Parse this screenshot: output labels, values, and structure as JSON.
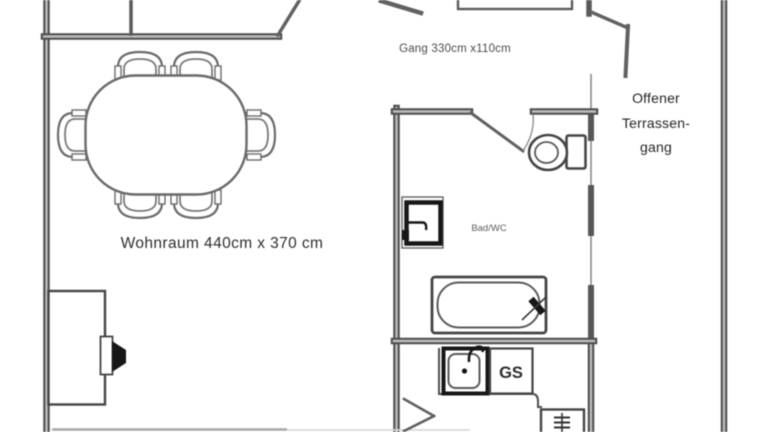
{
  "rooms": [
    {
      "name": "Wohnraum",
      "label": "Wohnraum 440cm x 370 cm"
    },
    {
      "name": "Gang",
      "label": "Gang 330cm x110cm"
    },
    {
      "name": "Bad/WC",
      "label": "Bad/WC"
    },
    {
      "name": "Offener Terrassengang",
      "label_lines": [
        "Offener",
        "Terrassen-",
        "gang"
      ]
    }
  ],
  "fixtures": {
    "dishwasher_label": "GS"
  },
  "colors": {
    "background": "#ffffff",
    "wall": "#4d4d4d",
    "wall_core": "#bdbdbd",
    "fixture_line": "#4f4f4f",
    "fixture_black": "#171717",
    "text_dark": "#2d2d2d",
    "text_muted": "#5d5d5d"
  },
  "icons": {
    "dining-table-icon": "rounded-oval-table",
    "chair-icon": "arched-back-chair",
    "toilet-icon": "tank-and-bowl",
    "washbasin-icon": "black-bordered-basin",
    "bathtub-icon": "rounded-tub-with-faucet",
    "kitchen-sink-icon": "basin-with-drain-dot-and-tap",
    "dishwasher-icon": "labeled-box",
    "radiator-icon": "ladder-in-box",
    "tv-icon": "black-wedge-on-sideboard",
    "door-swing-icon": "diagonal-door-leaf"
  }
}
